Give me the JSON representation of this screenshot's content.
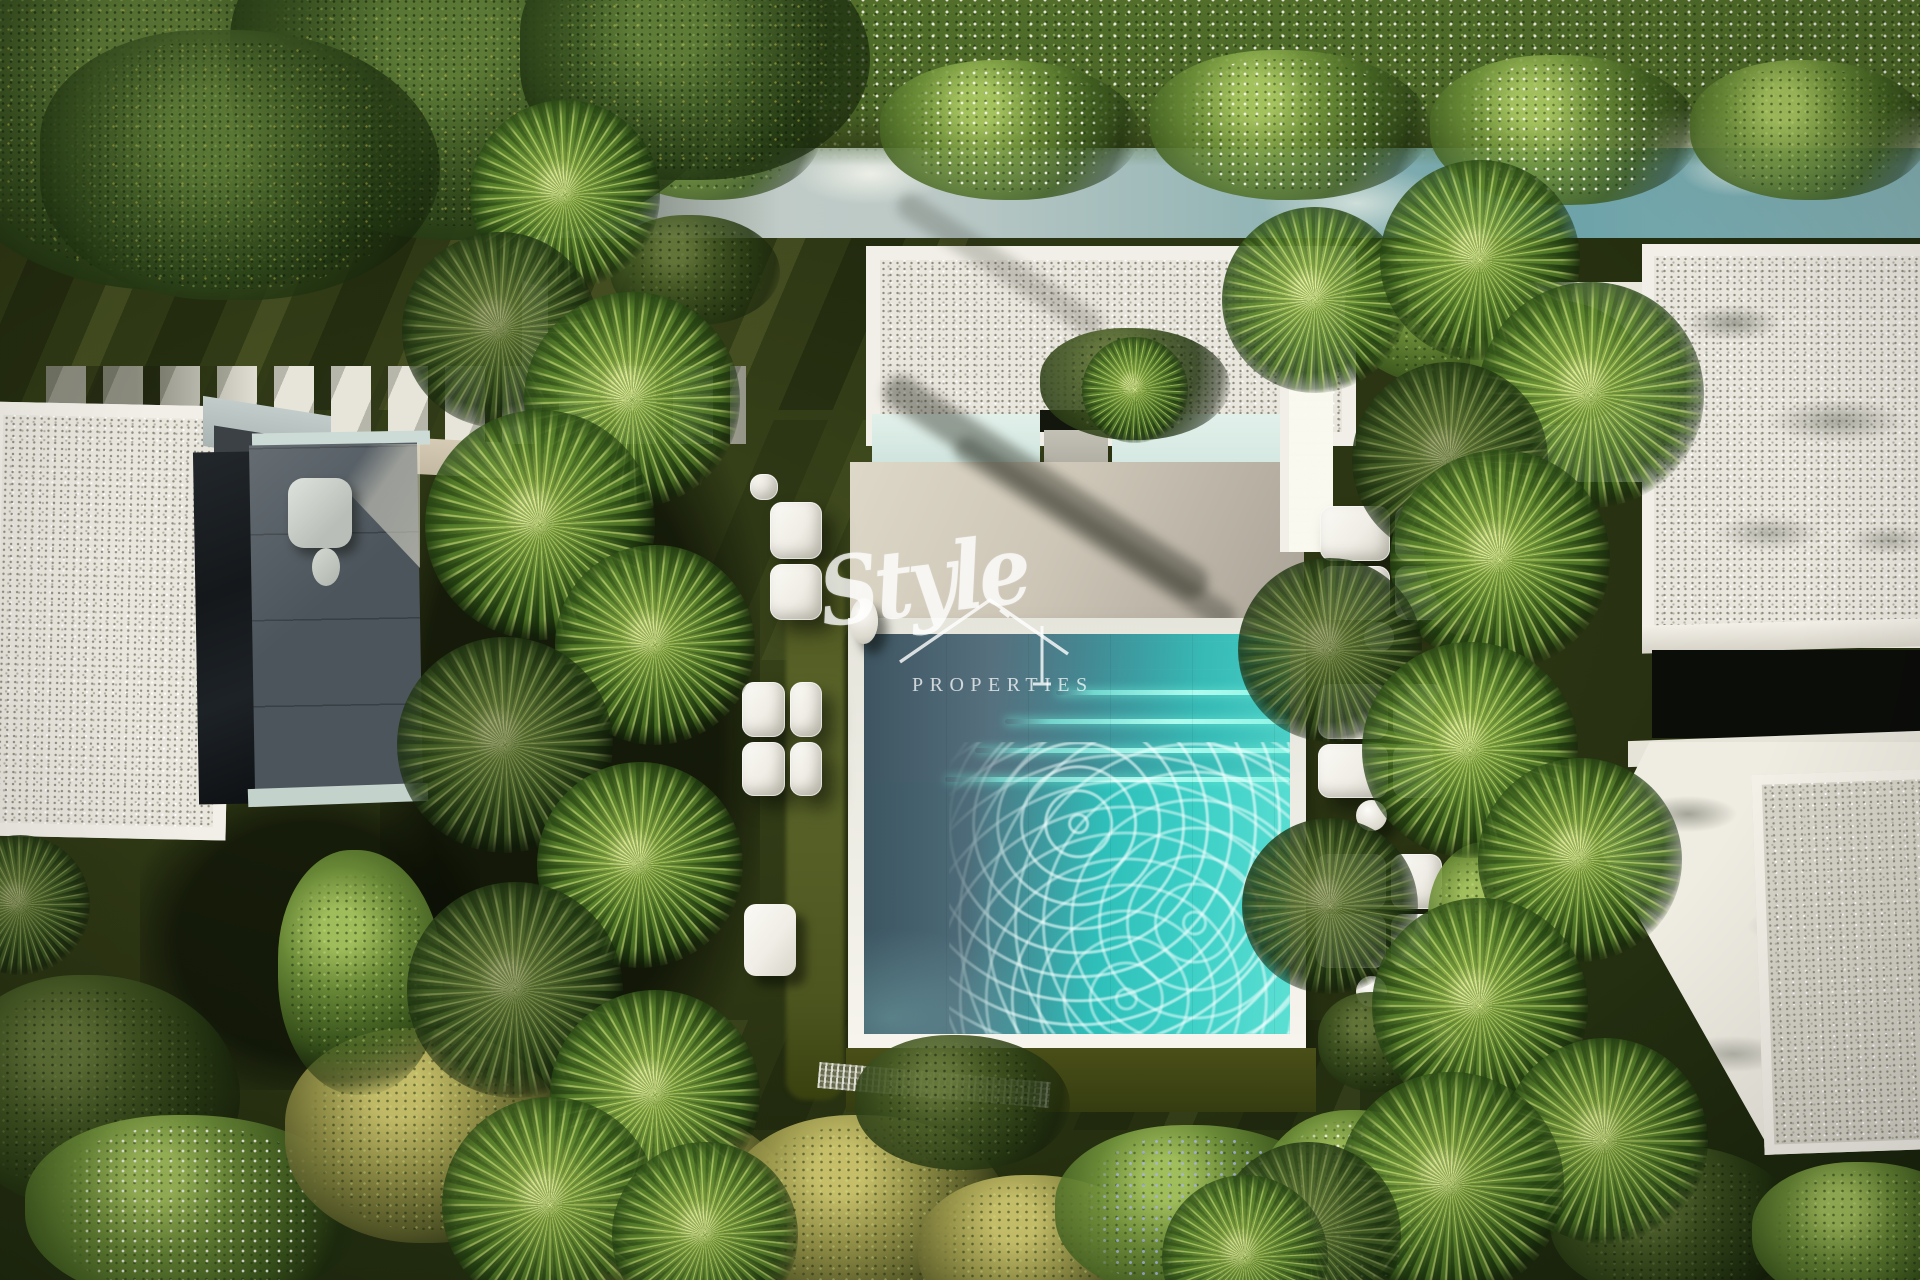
{
  "watermark": {
    "brand": "Style",
    "tagline": "PROPERTIES",
    "icon": "house-roof-icon"
  },
  "scene": {
    "type": "aerial-photograph",
    "subject": "Top-down view of a modern white villa with square plunge pool, stone sun deck, palm garden, white sun loungers with side tables, gravel flat roofs, stepping-stone path and dense hedges",
    "elements": [
      "tree-canopy",
      "flowering-hedge",
      "garden-wall",
      "stepping-stones",
      "left-villa",
      "outdoor-shower",
      "central-villa-roof",
      "pool-terrace",
      "plunge-pool",
      "pool-steps",
      "sun-loungers",
      "side-tables",
      "palm-trees",
      "right-villa",
      "gravel-roof",
      "garden-fence",
      "flower-bushes"
    ]
  },
  "palette": {
    "lawn-dark": "#2c3513",
    "lawn-lit": "#5c672b",
    "canopy-green": "#3f5724",
    "hedge-green": "#7c9a45",
    "white-arch": "#f1efe7",
    "gravel": "#e9e6de",
    "patio-beige": "#cdc6b7",
    "patio-gray": "#4c555c",
    "mint-wall": "#e2f0ea",
    "teal-band": "#6fa5ab",
    "pool-shadow": "#51707e",
    "pool-teal": "#2fc3bf",
    "pool-glow": "#8df0e0",
    "lounger-white": "#f6f4ee",
    "trunk-tan": "#b7a482",
    "glass-dark": "#101310",
    "wm": "rgba(255,255,255,0.74)"
  }
}
